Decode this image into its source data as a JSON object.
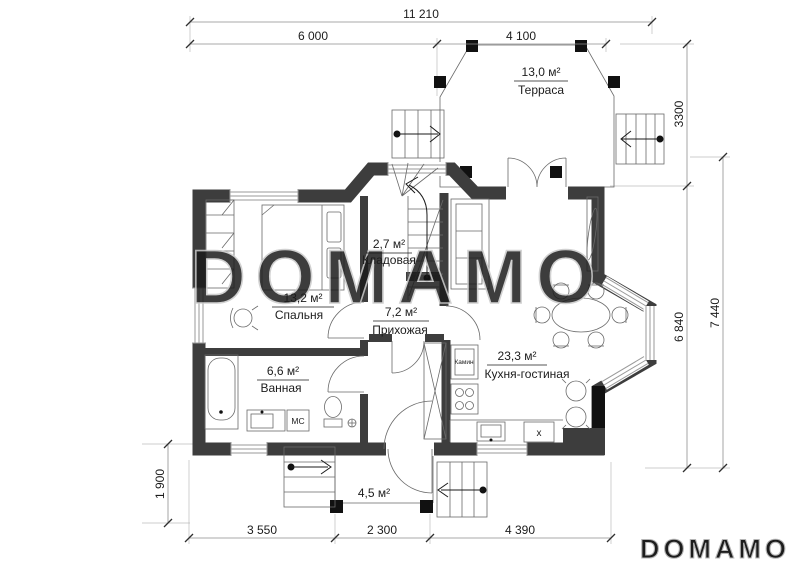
{
  "watermark": {
    "text": "DOMAMO"
  },
  "logo": {
    "text": "DOMAMO"
  },
  "dimensions": {
    "top_total": "11 210",
    "top_left_span": "6 000",
    "top_terrace_span": "4 100",
    "right_terrace_depth": "3300",
    "right_house_depth": "6 840",
    "right_total_depth": "7 440",
    "left_porch_depth": "1 900",
    "bottom_left_span": "3 550",
    "bottom_porch_span": "2 300",
    "bottom_right_span": "4 390"
  },
  "rooms": {
    "terrace": {
      "area": "13,0 м²",
      "name": "Терраса"
    },
    "storage": {
      "area": "2,7 м²",
      "name": "Кладовая"
    },
    "bedroom": {
      "area": "13,2 м²",
      "name": "Спальня"
    },
    "hallway": {
      "area": "7,2 м²",
      "name": "Прихожая"
    },
    "bathroom": {
      "area": "6,6 м²",
      "name": "Ванная"
    },
    "kitchen_living": {
      "area": "23,3 м²",
      "name": "Кухня-гостиная"
    },
    "porch": {
      "area": "4,5 м²"
    }
  },
  "annotations": {
    "fireplace": "Камин",
    "washer": "МС",
    "stove_mark": "x"
  },
  "colors": {
    "wall": "#3d3d3d",
    "column": "#111111",
    "watermark": "#c9c9c9",
    "dimension_line": "#8f8f8f"
  }
}
